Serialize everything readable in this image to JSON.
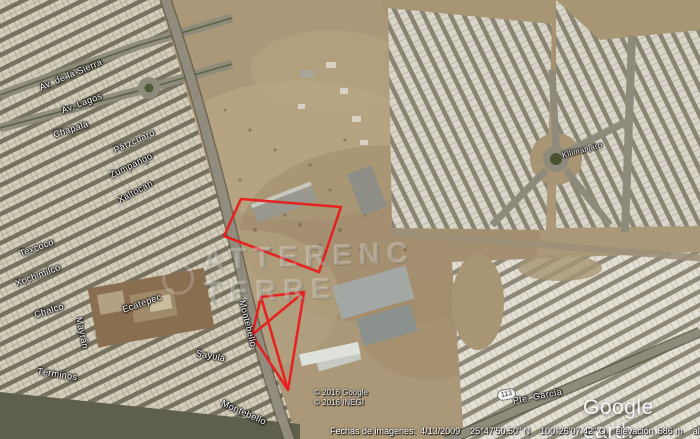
{
  "app": {
    "name": "Google Earth"
  },
  "map": {
    "watermark": "ATTERENC TERRE",
    "streets": [
      {
        "name": "Av. de la Sierra"
      },
      {
        "name": "Av. Lagos"
      },
      {
        "name": "Chapala"
      },
      {
        "name": "Pátzcuaro"
      },
      {
        "name": "Zumpango"
      },
      {
        "name": "Xaltocan"
      },
      {
        "name": "Texcoco"
      },
      {
        "name": "Xochimilco"
      },
      {
        "name": "Chalco"
      },
      {
        "name": "Ecatepec"
      },
      {
        "name": "Mayrán"
      },
      {
        "name": "Términos"
      },
      {
        "name": "Sayula"
      },
      {
        "name": "Montebello"
      },
      {
        "name": "Montebello"
      },
      {
        "name": "Kilimanjaro"
      },
      {
        "name": "Pte. García"
      }
    ],
    "route_shield": "113",
    "copyright_line1": "© 2016 Google",
    "copyright_line2": "© 2016 INEGI",
    "logo_text": "Google earth"
  },
  "overlays": {
    "outline_color": "#e81e1e",
    "parcel1": {
      "points": "224,236 241,199 341,207 319,272"
    },
    "parcel2": {
      "points": "261,297 304,292 288,390 252,335",
      "cross_path": "M261,297 L288,390 M304,292 L252,335"
    }
  },
  "status_bar": {
    "imagery_date_label": "Fechas de imágenes:",
    "imagery_date": "4/13/2009",
    "latitude": "25°47'50.50\" N",
    "longitude": "100°26'07.42\" O",
    "elevation_label": "elevación",
    "elevation": "586 m",
    "eye_alt_label": "alt. ojo",
    "eye_alt": "1.25 km"
  }
}
